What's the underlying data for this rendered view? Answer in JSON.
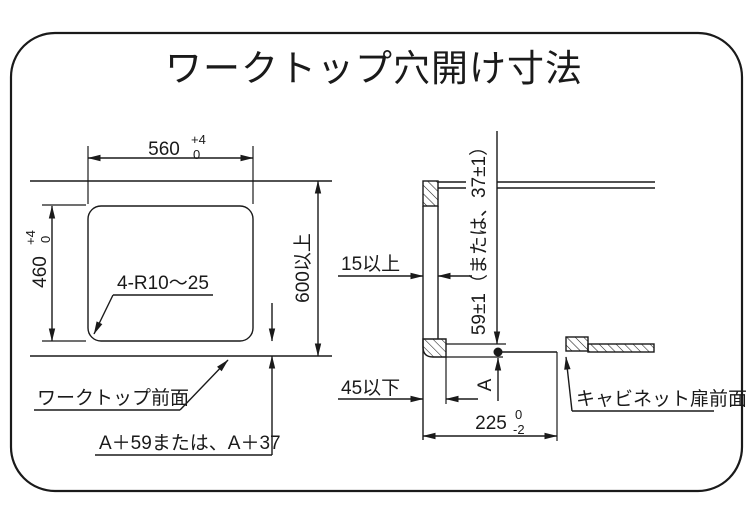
{
  "title": "ワークトップ穴開け寸法",
  "plan_view": {
    "hole_width": {
      "value": "560",
      "tol_upper": "+4",
      "tol_lower": "0"
    },
    "hole_height": {
      "value": "460",
      "tol_upper": "+4",
      "tol_lower": "0"
    },
    "corner_radius_note": "4-R10～25",
    "min_worktop_depth": "600以上",
    "worktop_front_label": "ワークトップ前面",
    "front_distance_formula": "A＋59または、A＋37"
  },
  "section_view": {
    "front_edge_min": "15以上",
    "front_edge_max": "45以下",
    "drop_dimension": "59±1（または、37±1）",
    "point_label": "A",
    "setback": {
      "value": "225",
      "tol_upper": "0",
      "tol_lower": "-2"
    },
    "cabinet_front_label": "キャビネット扉前面"
  },
  "colors": {
    "line": "#1a1a1a",
    "background": "#ffffff"
  }
}
